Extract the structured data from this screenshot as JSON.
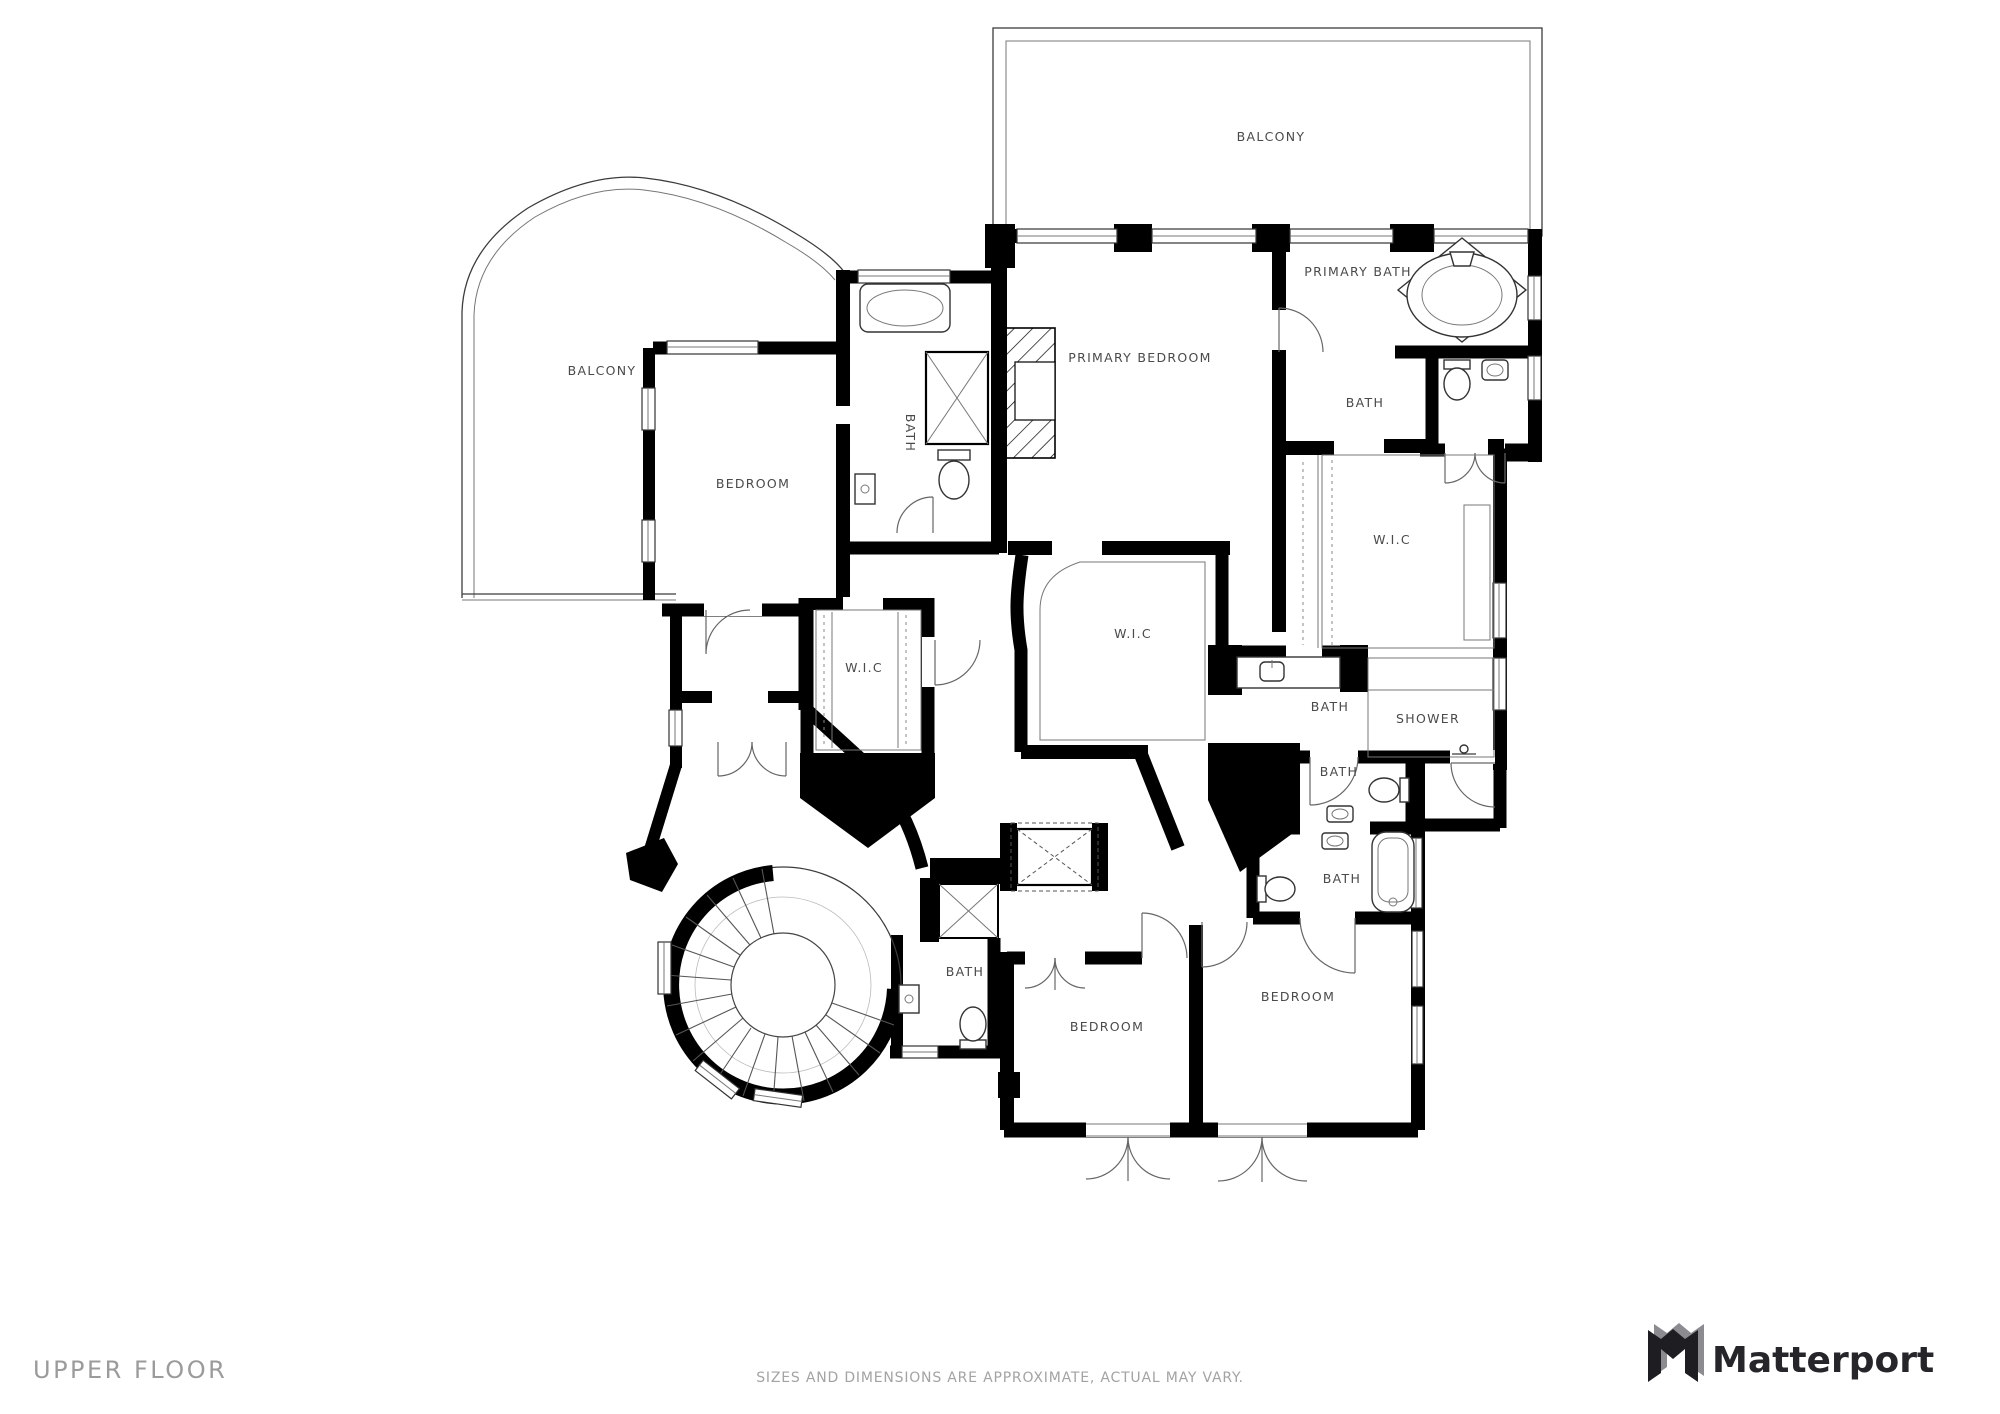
{
  "page": {
    "background": "#ffffff"
  },
  "colors": {
    "wall": "#000000",
    "room_label": "#4a4a4a",
    "footer_text": "#9b9b9b",
    "disclaimer_text": "#a3a3a3",
    "brand_text": "#25252a",
    "logo_gray": "#8b8b90"
  },
  "floor_plan": {
    "rooms": [
      {
        "id": "balcony-top",
        "label": "BALCONY"
      },
      {
        "id": "primary-bath",
        "label": "PRIMARY BATH"
      },
      {
        "id": "primary-bedroom",
        "label": "PRIMARY BEDROOM"
      },
      {
        "id": "bath-primary-toilet",
        "label": "BATH"
      },
      {
        "id": "bath-left",
        "label": "BATH"
      },
      {
        "id": "balcony-left",
        "label": "BALCONY"
      },
      {
        "id": "bedroom-left",
        "label": "BEDROOM"
      },
      {
        "id": "wic-right",
        "label": "W.I.C"
      },
      {
        "id": "wic-center",
        "label": "W.I.C"
      },
      {
        "id": "wic-left",
        "label": "W.I.C"
      },
      {
        "id": "bath-mid-right",
        "label": "BATH"
      },
      {
        "id": "shower",
        "label": "SHOWER"
      },
      {
        "id": "bath-small-right",
        "label": "BATH"
      },
      {
        "id": "bath-lower-right",
        "label": "BATH"
      },
      {
        "id": "bath-bottom",
        "label": "BATH"
      },
      {
        "id": "bedroom-bottom-right",
        "label": "BEDROOM"
      },
      {
        "id": "bedroom-bottom-center",
        "label": "BEDROOM"
      }
    ]
  },
  "footer": {
    "floor_label": "UPPER FLOOR",
    "disclaimer": "SIZES AND DIMENSIONS ARE APPROXIMATE, ACTUAL MAY VARY.",
    "brand": "Matterport"
  }
}
